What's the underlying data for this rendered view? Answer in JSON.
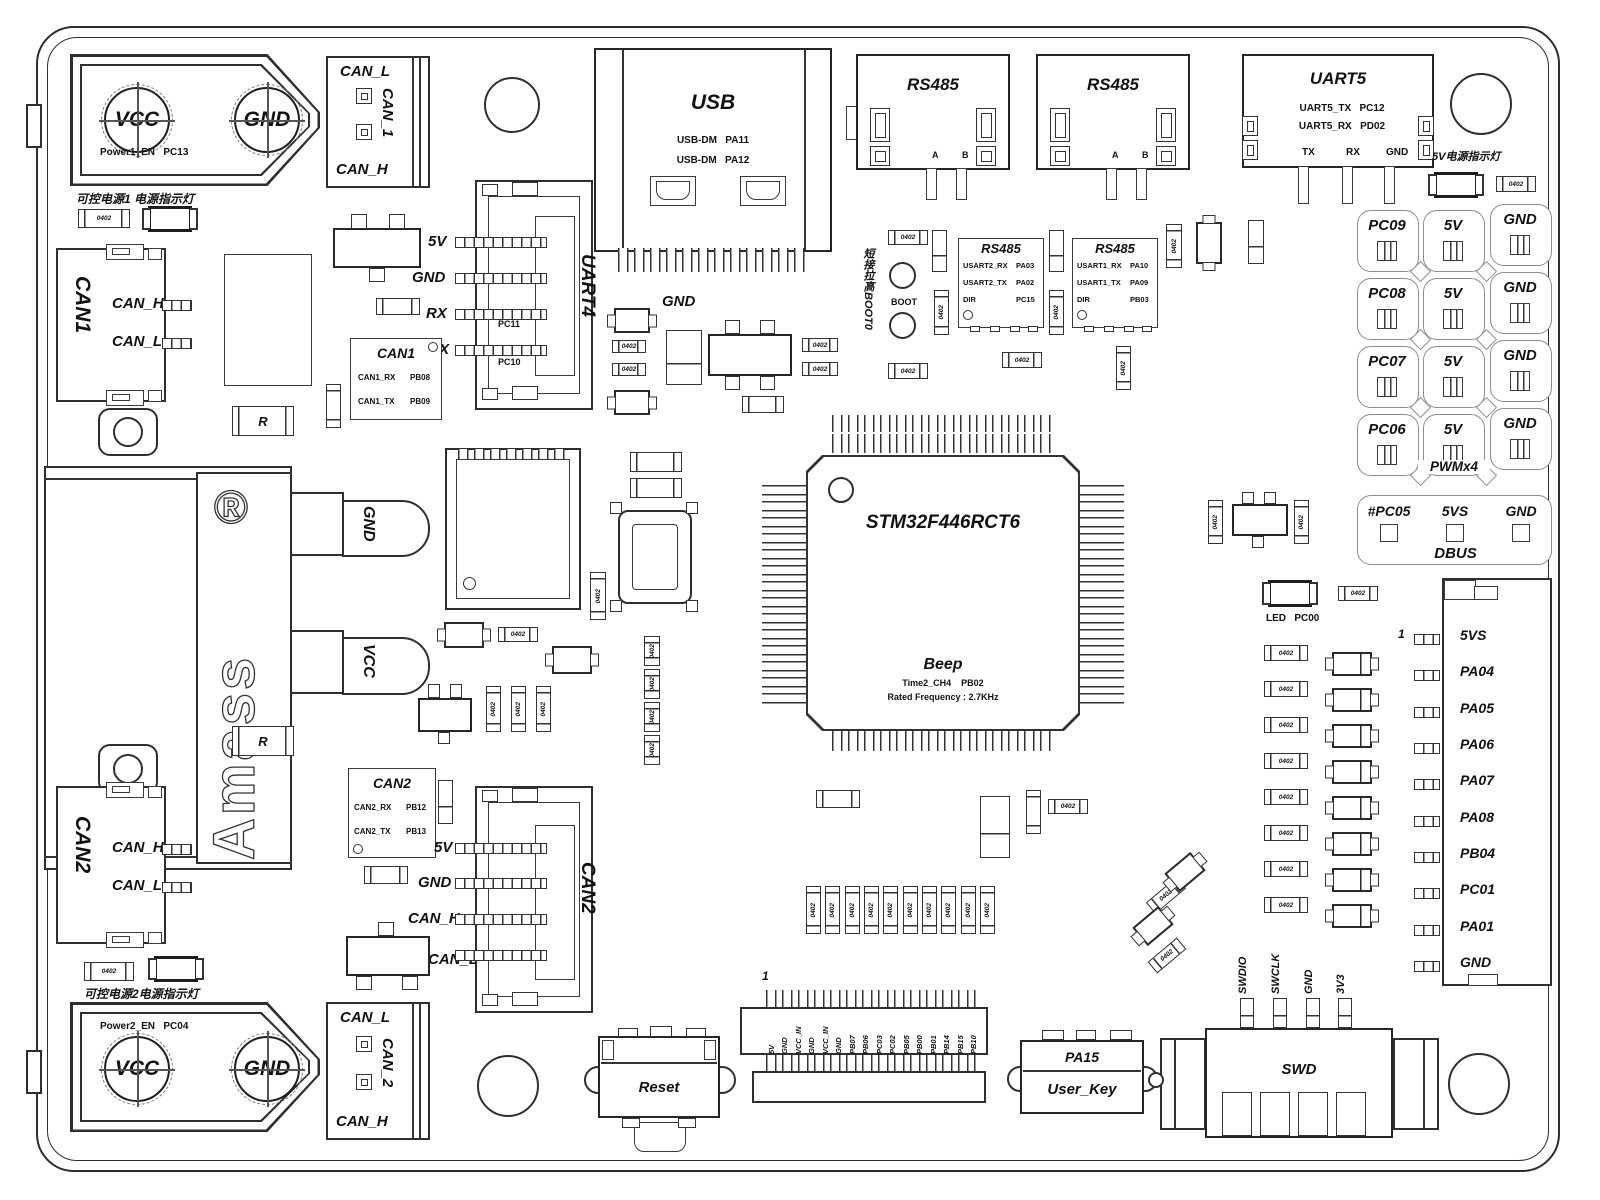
{
  "parts": {
    "r0402": "0402",
    "r": "R"
  },
  "power1": {
    "en": "Power1_EN",
    "en_pin": "PC13",
    "vcc": "VCC",
    "gnd": "GND",
    "cap": "可控电源1 电源指示灯",
    "blk": {
      "top": "CAN_L",
      "mid": "CAN_1",
      "bot": "CAN_H"
    }
  },
  "power2": {
    "en": "Power2_EN",
    "en_pin": "PC04",
    "vcc": "VCC",
    "gnd": "GND",
    "cap": "可控电源2电源指示灯",
    "blk": {
      "top": "CAN_L",
      "mid": "CAN_2",
      "bot": "CAN_H"
    }
  },
  "can1": {
    "name": "CAN1",
    "h": "CAN_H",
    "l": "CAN_L"
  },
  "can2": {
    "name": "CAN2",
    "h": "CAN_H",
    "l": "CAN_L"
  },
  "amass": {
    "brand": "Amass",
    "reg": "®",
    "gnd": "GND",
    "vcc": "VCC"
  },
  "usb": {
    "title": "USB",
    "r1a": "USB-DM",
    "r1b": "PA11",
    "r2a": "USB-DM",
    "r2b": "PA12"
  },
  "uart4": {
    "name": "UART4",
    "p1": "5V",
    "p2": "GND",
    "p3": "RX",
    "p4": "TX",
    "i1": "PC11",
    "i2": "PC10"
  },
  "can1chip": {
    "t": "CAN1",
    "r1a": "CAN1_RX",
    "r1b": "PB08",
    "r2a": "CAN1_TX",
    "r2b": "PB09"
  },
  "can2chip": {
    "t": "CAN2",
    "r1a": "CAN2_RX",
    "r1b": "PB12",
    "r2a": "CAN2_TX",
    "r2b": "PB13"
  },
  "can2jst": {
    "name": "CAN2",
    "p1": "5V",
    "p2": "GND",
    "p3": "CAN_H",
    "p4": "CAN_L"
  },
  "rs485a": {
    "t": "RS485",
    "a": "A",
    "b": "B"
  },
  "rs485b": {
    "t": "RS485",
    "a": "A",
    "b": "B"
  },
  "uart5": {
    "t": "UART5",
    "r1a": "UART5_TX",
    "r1b": "PC12",
    "r2a": "UART5_RX",
    "r2b": "PD02",
    "p1": "TX",
    "p2": "RX",
    "p3": "GND"
  },
  "led5v": {
    "cap": "5V电源指示灯"
  },
  "boot": {
    "note": "短接拉高BOOT0",
    "t": "BOOT"
  },
  "u485a": {
    "t": "RS485",
    "r1a": "USART2_RX",
    "r1b": "PA03",
    "r2a": "USART2_TX",
    "r2b": "PA02",
    "r3a": "DIR",
    "r3b": "PC15"
  },
  "u485b": {
    "t": "RS485",
    "r1a": "USART1_RX",
    "r1b": "PA10",
    "r2a": "USART1_TX",
    "r2b": "PA09",
    "r3a": "DIR",
    "r3b": "PB03"
  },
  "mcu": {
    "part": "STM32F446RCT6",
    "beep": "Beep",
    "ch": "Time2_CH4",
    "chpin": "PB02",
    "freq": "Rated Frequency : 2.7KHz"
  },
  "gndmid": "GND",
  "pwm": {
    "s1": "PC09",
    "s2": "PC08",
    "s3": "PC07",
    "s4": "PC06",
    "v": "5V",
    "g": "GND",
    "cap": "PWMx4"
  },
  "dbus": {
    "sig": "#PC05",
    "v": "5VS",
    "g": "GND",
    "cap": "DBUS"
  },
  "ledpc00": {
    "led": "LED",
    "pin": "PC00"
  },
  "rconn": {
    "one": "1",
    "pins": [
      "5VS",
      "PA04",
      "PA05",
      "PA06",
      "PA07",
      "PA08",
      "PB04",
      "PC01",
      "PA01",
      "GND"
    ]
  },
  "bheader": {
    "one": "1",
    "pins": [
      "5V",
      "GND",
      "VCC_IN",
      "GND",
      "VCC_IN",
      "GND",
      "PB07",
      "PB06",
      "PC03",
      "PC02",
      "PB05",
      "PB00",
      "PB01",
      "PB14",
      "PB15",
      "PB10"
    ]
  },
  "reset": {
    "t": "Reset"
  },
  "ukey": {
    "pin": "PA15",
    "t": "User_Key"
  },
  "swd": {
    "t": "SWD",
    "pins": [
      "SWDIO",
      "SWCLK",
      "GND",
      "3V3"
    ]
  }
}
